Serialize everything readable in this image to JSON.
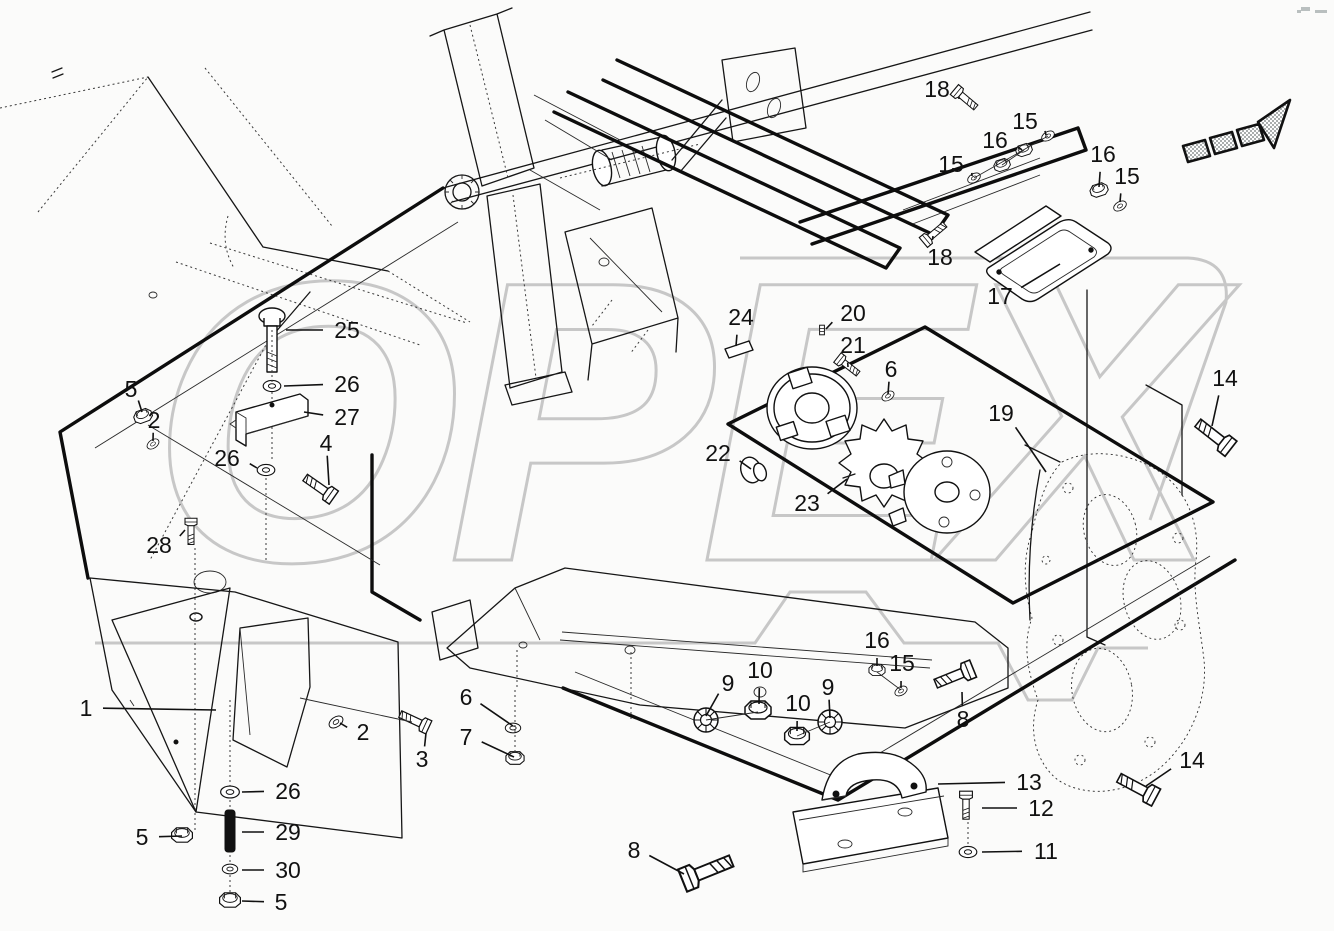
{
  "diagram": {
    "kind": "exploded-parts-diagram",
    "watermark_text": "OPEX",
    "colors": {
      "line": "#161616",
      "thick_line": "#0d0d0d",
      "watermark": "#c7c7c7",
      "background": "#fbfbfa"
    }
  },
  "direction_arrow": {
    "label": "direction-arrow"
  },
  "callouts": [
    {
      "label": "18",
      "tx": 937,
      "ty": 89,
      "px": 959,
      "py": 99
    },
    {
      "label": "15",
      "tx": 1025,
      "ty": 121,
      "px": 1046,
      "py": 135
    },
    {
      "label": "16",
      "tx": 995,
      "ty": 140,
      "px": 1022,
      "py": 150
    },
    {
      "label": "15",
      "tx": 951,
      "ty": 164,
      "px": 972,
      "py": 176
    },
    {
      "label": "16",
      "tx": 1103,
      "ty": 154,
      "px": 1099,
      "py": 187
    },
    {
      "label": "15",
      "tx": 1127,
      "ty": 176,
      "px": 1120,
      "py": 202
    },
    {
      "label": "18",
      "tx": 940,
      "ty": 257,
      "px": 933,
      "py": 236
    },
    {
      "label": "17",
      "tx": 1000,
      "ty": 296,
      "px": 1060,
      "py": 264
    },
    {
      "label": "14",
      "tx": 1225,
      "ty": 378,
      "px": 1212,
      "py": 426
    },
    {
      "label": "25",
      "tx": 347,
      "ty": 330,
      "px": 286,
      "py": 330
    },
    {
      "label": "26",
      "tx": 347,
      "ty": 384,
      "px": 284,
      "py": 386
    },
    {
      "label": "27",
      "tx": 347,
      "ty": 417,
      "px": 304,
      "py": 412
    },
    {
      "label": "5",
      "tx": 131,
      "ty": 389,
      "px": 142,
      "py": 412
    },
    {
      "label": "2",
      "tx": 154,
      "ty": 420,
      "px": 153,
      "py": 441
    },
    {
      "label": "26",
      "tx": 227,
      "ty": 458,
      "px": 257,
      "py": 468
    },
    {
      "label": "4",
      "tx": 326,
      "ty": 443,
      "px": 329,
      "py": 485
    },
    {
      "label": "28",
      "tx": 159,
      "ty": 545,
      "px": 185,
      "py": 530
    },
    {
      "label": "24",
      "tx": 741,
      "ty": 317,
      "px": 736,
      "py": 346
    },
    {
      "label": "20",
      "tx": 853,
      "ty": 313,
      "px": 826,
      "py": 329
    },
    {
      "label": "21",
      "tx": 853,
      "ty": 345,
      "px": 848,
      "py": 367
    },
    {
      "label": "6",
      "tx": 891,
      "ty": 369,
      "px": 888,
      "py": 394
    },
    {
      "label": "19",
      "tx": 1001,
      "ty": 413,
      "px": 1046,
      "py": 472
    },
    {
      "label": "22",
      "tx": 718,
      "ty": 453,
      "px": 751,
      "py": 469
    },
    {
      "label": "23",
      "tx": 807,
      "ty": 503,
      "px": 847,
      "py": 479
    },
    {
      "label": "1",
      "tx": 86,
      "ty": 708,
      "px": 216,
      "py": 710
    },
    {
      "label": "2",
      "tx": 363,
      "ty": 732,
      "px": 340,
      "py": 723
    },
    {
      "label": "3",
      "tx": 422,
      "ty": 759,
      "px": 426,
      "py": 733
    },
    {
      "label": "5",
      "tx": 142,
      "ty": 837,
      "px": 182,
      "py": 836
    },
    {
      "label": "26",
      "tx": 288,
      "ty": 791,
      "px": 242,
      "py": 792
    },
    {
      "label": "29",
      "tx": 288,
      "ty": 832,
      "px": 242,
      "py": 832
    },
    {
      "label": "30",
      "tx": 288,
      "ty": 870,
      "px": 242,
      "py": 870
    },
    {
      "label": "5",
      "tx": 281,
      "ty": 902,
      "px": 242,
      "py": 901
    },
    {
      "label": "6",
      "tx": 466,
      "ty": 697,
      "px": 513,
      "py": 726
    },
    {
      "label": "7",
      "tx": 466,
      "ty": 737,
      "px": 514,
      "py": 757
    },
    {
      "label": "8",
      "tx": 634,
      "ty": 850,
      "px": 684,
      "py": 874
    },
    {
      "label": "9",
      "tx": 728,
      "ty": 683,
      "px": 706,
      "py": 716
    },
    {
      "label": "10",
      "tx": 760,
      "ty": 670,
      "px": 759,
      "py": 704
    },
    {
      "label": "10",
      "tx": 798,
      "ty": 703,
      "px": 797,
      "py": 731
    },
    {
      "label": "9",
      "tx": 828,
      "ty": 687,
      "px": 830,
      "py": 718
    },
    {
      "label": "16",
      "tx": 877,
      "ty": 640,
      "px": 877,
      "py": 666
    },
    {
      "label": "15",
      "tx": 902,
      "ty": 663,
      "px": 901,
      "py": 688
    },
    {
      "label": "8",
      "tx": 963,
      "ty": 719,
      "px": 962,
      "py": 692
    },
    {
      "label": "13",
      "tx": 1029,
      "ty": 782,
      "px": 938,
      "py": 784
    },
    {
      "label": "12",
      "tx": 1041,
      "ty": 808,
      "px": 982,
      "py": 808
    },
    {
      "label": "11",
      "tx": 1046,
      "ty": 851,
      "px": 982,
      "py": 852
    },
    {
      "label": "14",
      "tx": 1192,
      "ty": 760,
      "px": 1146,
      "py": 786
    }
  ]
}
